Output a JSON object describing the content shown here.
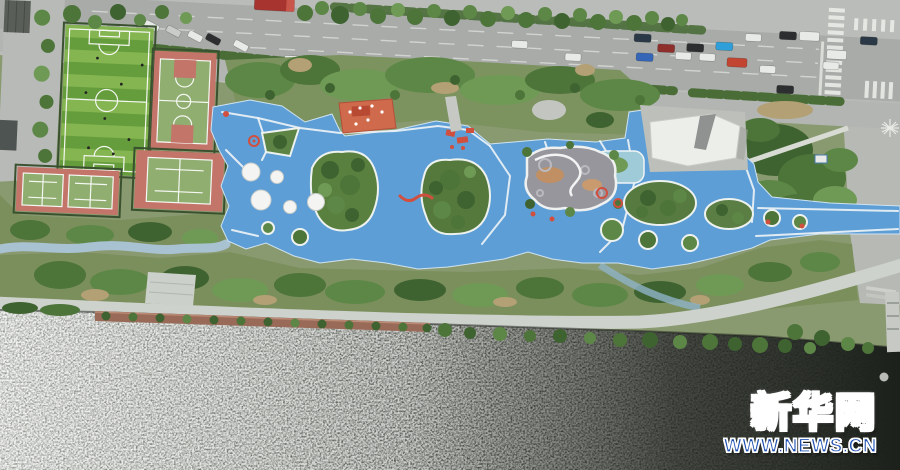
{
  "watermark": {
    "brand": "新华网",
    "url": "WWW.NEWS.CN"
  },
  "colors": {
    "watermark_blue": "#1d4fb0",
    "playground_blue": "#5d9ed6",
    "jog_path_blue": "#a9c2d2",
    "court_red": "#c4756a",
    "court_green": "#8fae70",
    "soccer_green_light": "#84b551",
    "soccer_green_dark": "#669d3c",
    "road_asphalt": "#a8aba8",
    "pavement": "#b9bcb8",
    "water_dark": "#1d211c",
    "water_silver": "#90958d",
    "deck_brown": "#9a6a58",
    "orange_building": "#cf6a4c"
  }
}
